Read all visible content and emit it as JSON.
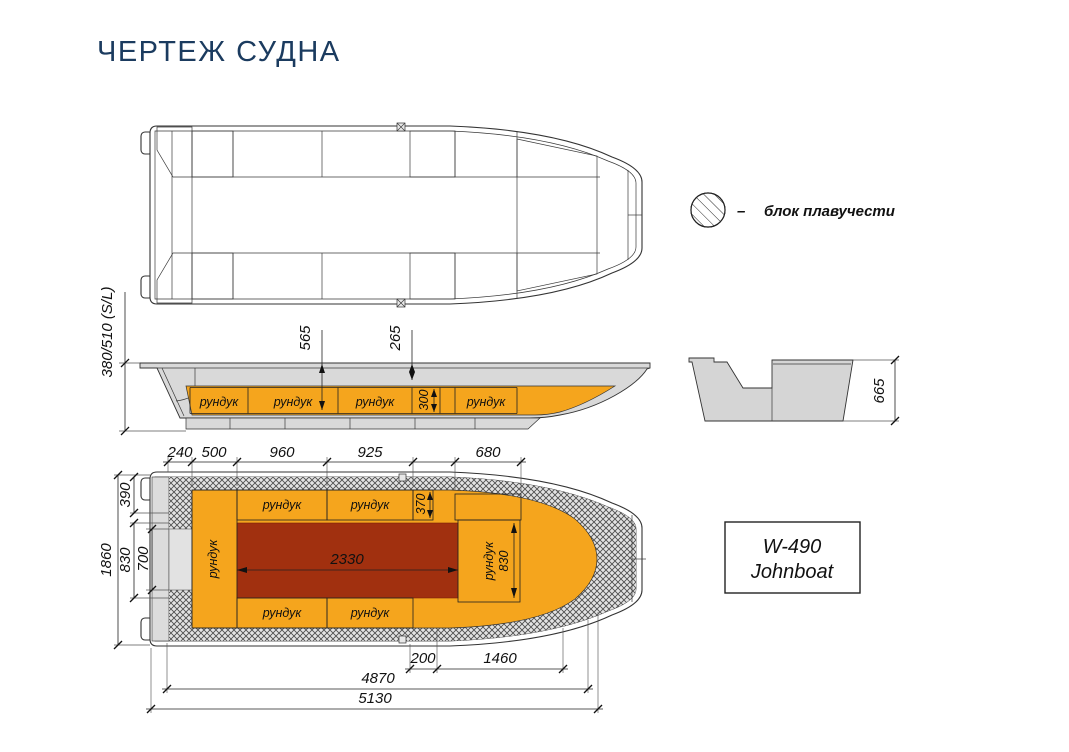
{
  "title": "ЧЕРТЕЖ СУДНА",
  "legend": {
    "dash": "–",
    "label": "блок плавучести"
  },
  "colors": {
    "accent_orange": "#F5A51D",
    "floor_red": "#A1300F",
    "hull_gray": "#D9D9D9",
    "title_navy": "#1B3B5F"
  },
  "side_view": {
    "dim_depth": "380/510 (S/L)",
    "dim_565": "565",
    "dim_265": "265",
    "dim_300": "300",
    "lockers": [
      "рундук",
      "рундук",
      "рундук",
      "рундук"
    ]
  },
  "cross_section": {
    "dim_665": "665"
  },
  "bottom_view": {
    "top_dims": [
      "240",
      "500",
      "960",
      "925",
      "680"
    ],
    "left_dims": {
      "overall": "1860",
      "d390": "390",
      "d830": "830",
      "d700": "700"
    },
    "inner_dims": {
      "d370": "370",
      "d2330": "2330",
      "d830": "830"
    },
    "bottom_dims": [
      "200",
      "1460",
      "4870",
      "5130"
    ],
    "lockers": {
      "top": [
        "рундук",
        "рундук"
      ],
      "bottom": [
        "рундук",
        "рундук"
      ],
      "left": "рундук",
      "right": "рундук"
    }
  },
  "model_box": {
    "line1": "W-490",
    "line2": "Johnboat"
  }
}
